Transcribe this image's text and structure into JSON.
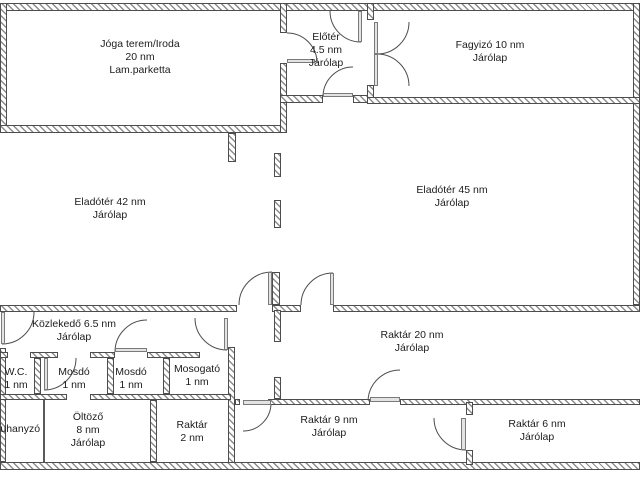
{
  "canvas": {
    "width": 640,
    "height": 480,
    "background": "#ffffff"
  },
  "colors": {
    "wall_border": "#4d4d4d",
    "wall_hatch": "#8c8c8c",
    "door_line": "#4d4d4d",
    "leaf_fill": "#e3e3e3",
    "leaf_border": "#7a7a7a",
    "text": "#1c1c1c"
  },
  "rooms": [
    {
      "name": "joga-terem-iroda",
      "cx": 140,
      "cy": 38,
      "lines": [
        "Jóga terem/Iroda",
        "20 nm",
        "Lam.parketta"
      ]
    },
    {
      "name": "eloter",
      "cx": 326,
      "cy": 31,
      "lines": [
        "Előtér",
        "4.5 nm",
        "Járólap"
      ]
    },
    {
      "name": "fagyizo",
      "cx": 490,
      "cy": 39,
      "lines": [
        "Fagyizó 10 nm",
        "Járólap"
      ]
    },
    {
      "name": "eladoter-42",
      "cx": 110,
      "cy": 196,
      "lines": [
        "Eladótér 42 nm",
        "Járólap"
      ]
    },
    {
      "name": "eladoter-45",
      "cx": 452,
      "cy": 184,
      "lines": [
        "Eladótér 45 nm",
        "Járólap"
      ]
    },
    {
      "name": "kozlekedo",
      "cx": 74,
      "cy": 318,
      "lines": [
        "Közlekedő 6.5 nm",
        "Járólap"
      ]
    },
    {
      "name": "wc",
      "cx": 16,
      "cy": 366,
      "lines": [
        "W.C.",
        "1 nm"
      ]
    },
    {
      "name": "mosdo-1",
      "cx": 74,
      "cy": 366,
      "lines": [
        "Mosdó",
        "1 nm"
      ]
    },
    {
      "name": "mosdo-2",
      "cx": 131,
      "cy": 366,
      "lines": [
        "Mosdó",
        "1 nm"
      ]
    },
    {
      "name": "mosogato",
      "cx": 197,
      "cy": 363,
      "lines": [
        "Mosogató",
        "1 nm"
      ]
    },
    {
      "name": "zuhanyzo",
      "cx": 17,
      "cy": 423,
      "lines": [
        "Zuhanyzó"
      ]
    },
    {
      "name": "oltozo",
      "cx": 88,
      "cy": 411,
      "lines": [
        "Öltöző",
        "8 nm",
        "Járólap"
      ]
    },
    {
      "name": "raktar-2",
      "cx": 192,
      "cy": 419,
      "lines": [
        "Raktár",
        "2 nm"
      ]
    },
    {
      "name": "raktar-20",
      "cx": 412,
      "cy": 329,
      "lines": [
        "Raktár 20 nm",
        "Járólap"
      ]
    },
    {
      "name": "raktar-9",
      "cx": 329,
      "cy": 414,
      "lines": [
        "Raktár 9 nm",
        "Járólap"
      ]
    },
    {
      "name": "raktar-6",
      "cx": 537,
      "cy": 418,
      "lines": [
        "Raktár 6 nm",
        "Járólap"
      ]
    }
  ],
  "walls": [
    [
      0,
      3,
      640,
      8
    ],
    [
      0,
      3,
      7,
      130
    ],
    [
      633,
      3,
      7,
      302
    ],
    [
      0,
      125,
      287,
      8
    ],
    [
      280,
      3,
      7,
      30
    ],
    [
      280,
      63,
      7,
      70
    ],
    [
      280,
      95,
      43,
      8
    ],
    [
      353,
      95,
      17,
      8
    ],
    [
      367,
      3,
      7,
      17
    ],
    [
      367,
      85,
      7,
      19
    ],
    [
      367,
      97,
      273,
      7
    ],
    [
      228,
      133,
      8,
      29
    ],
    [
      274,
      153,
      7,
      24
    ],
    [
      274,
      200,
      7,
      28
    ],
    [
      272,
      272,
      8,
      33
    ],
    [
      0,
      305,
      237,
      7
    ],
    [
      272,
      305,
      29,
      7
    ],
    [
      333,
      305,
      307,
      7
    ],
    [
      228,
      347,
      7,
      118
    ],
    [
      0,
      348,
      6,
      114
    ],
    [
      0,
      352,
      8,
      6
    ],
    [
      30,
      352,
      28,
      6
    ],
    [
      90,
      352,
      25,
      6
    ],
    [
      147,
      352,
      53,
      6
    ],
    [
      34,
      358,
      7,
      36
    ],
    [
      107,
      358,
      7,
      36
    ],
    [
      163,
      358,
      7,
      36
    ],
    [
      0,
      394,
      67,
      6
    ],
    [
      90,
      394,
      141,
      6
    ],
    [
      150,
      400,
      7,
      62
    ],
    [
      0,
      462,
      640,
      8
    ],
    [
      235,
      399,
      5,
      6
    ],
    [
      268,
      399,
      102,
      6
    ],
    [
      400,
      399,
      240,
      6
    ],
    [
      466,
      402,
      7,
      13
    ],
    [
      466,
      450,
      7,
      15
    ],
    [
      274,
      310,
      7,
      32
    ],
    [
      274,
      377,
      7,
      22
    ]
  ],
  "thin_walls": [
    [
      43,
      400,
      2,
      62
    ]
  ],
  "doors": [
    {
      "name": "eloter-top-door",
      "arc": "M 330 11 A 31 31 0 0 0 361 42",
      "leaf": [
        358,
        11,
        4,
        31
      ]
    },
    {
      "name": "joga-eloter-door",
      "arc": "M 287 33 A 30 30 0 0 1 317 63",
      "leaf": [
        287,
        59,
        28,
        4
      ]
    },
    {
      "name": "eloter-bottom-door",
      "arc": "M 323 97 A 30 30 0 0 1 353 67",
      "leaf": [
        323,
        93,
        30,
        4
      ]
    },
    {
      "name": "fagyizo-double-door-a",
      "arc": "M 409 22 A 32 32 0 0 1 377 54",
      "leaf": [
        374,
        22,
        4,
        32
      ]
    },
    {
      "name": "fagyizo-double-door-b",
      "arc": "M 409 86 A 32 32 0 0 0 377 54",
      "leaf": [
        374,
        54,
        4,
        32
      ]
    },
    {
      "name": "eladoter-door-a",
      "arc": "M 239 305 A 33 33 0 0 1 272 272",
      "leaf": [
        268,
        272,
        4,
        33
      ]
    },
    {
      "name": "eladoter-door-b",
      "arc": "M 301 305 A 32 32 0 0 1 333 273",
      "leaf": [
        330,
        273,
        4,
        32
      ]
    },
    {
      "name": "entrance-door",
      "arc": "M 34 312 A 32 32 0 0 1 2 344",
      "leaf": [
        1,
        312,
        4,
        32
      ]
    },
    {
      "name": "passage-door",
      "arc": "M 195 318 A 32 32 0 0 0 227 350",
      "leaf": [
        224,
        318,
        4,
        32
      ]
    },
    {
      "name": "mosdo1-door",
      "arc": "M 76 358 A 32 32 0 0 1 44 390",
      "leaf": [
        44,
        358,
        4,
        32
      ]
    },
    {
      "name": "mosdo2-door",
      "arc": "M 115 352 A 32 32 0 0 1 147 320",
      "leaf": [
        115,
        348,
        32,
        4
      ]
    },
    {
      "name": "raktar9-door",
      "arc": "M 271 403 A 28 28 0 0 1 243 431",
      "leaf": [
        243,
        400,
        28,
        5
      ]
    },
    {
      "name": "raktar20-door",
      "arc": "M 368 402 A 32 32 0 0 1 400 370",
      "leaf": [
        370,
        397,
        30,
        5
      ]
    },
    {
      "name": "raktar6-door",
      "arc": "M 434 418 A 32 32 0 0 0 466 450",
      "leaf": [
        461,
        418,
        5,
        32
      ]
    }
  ]
}
